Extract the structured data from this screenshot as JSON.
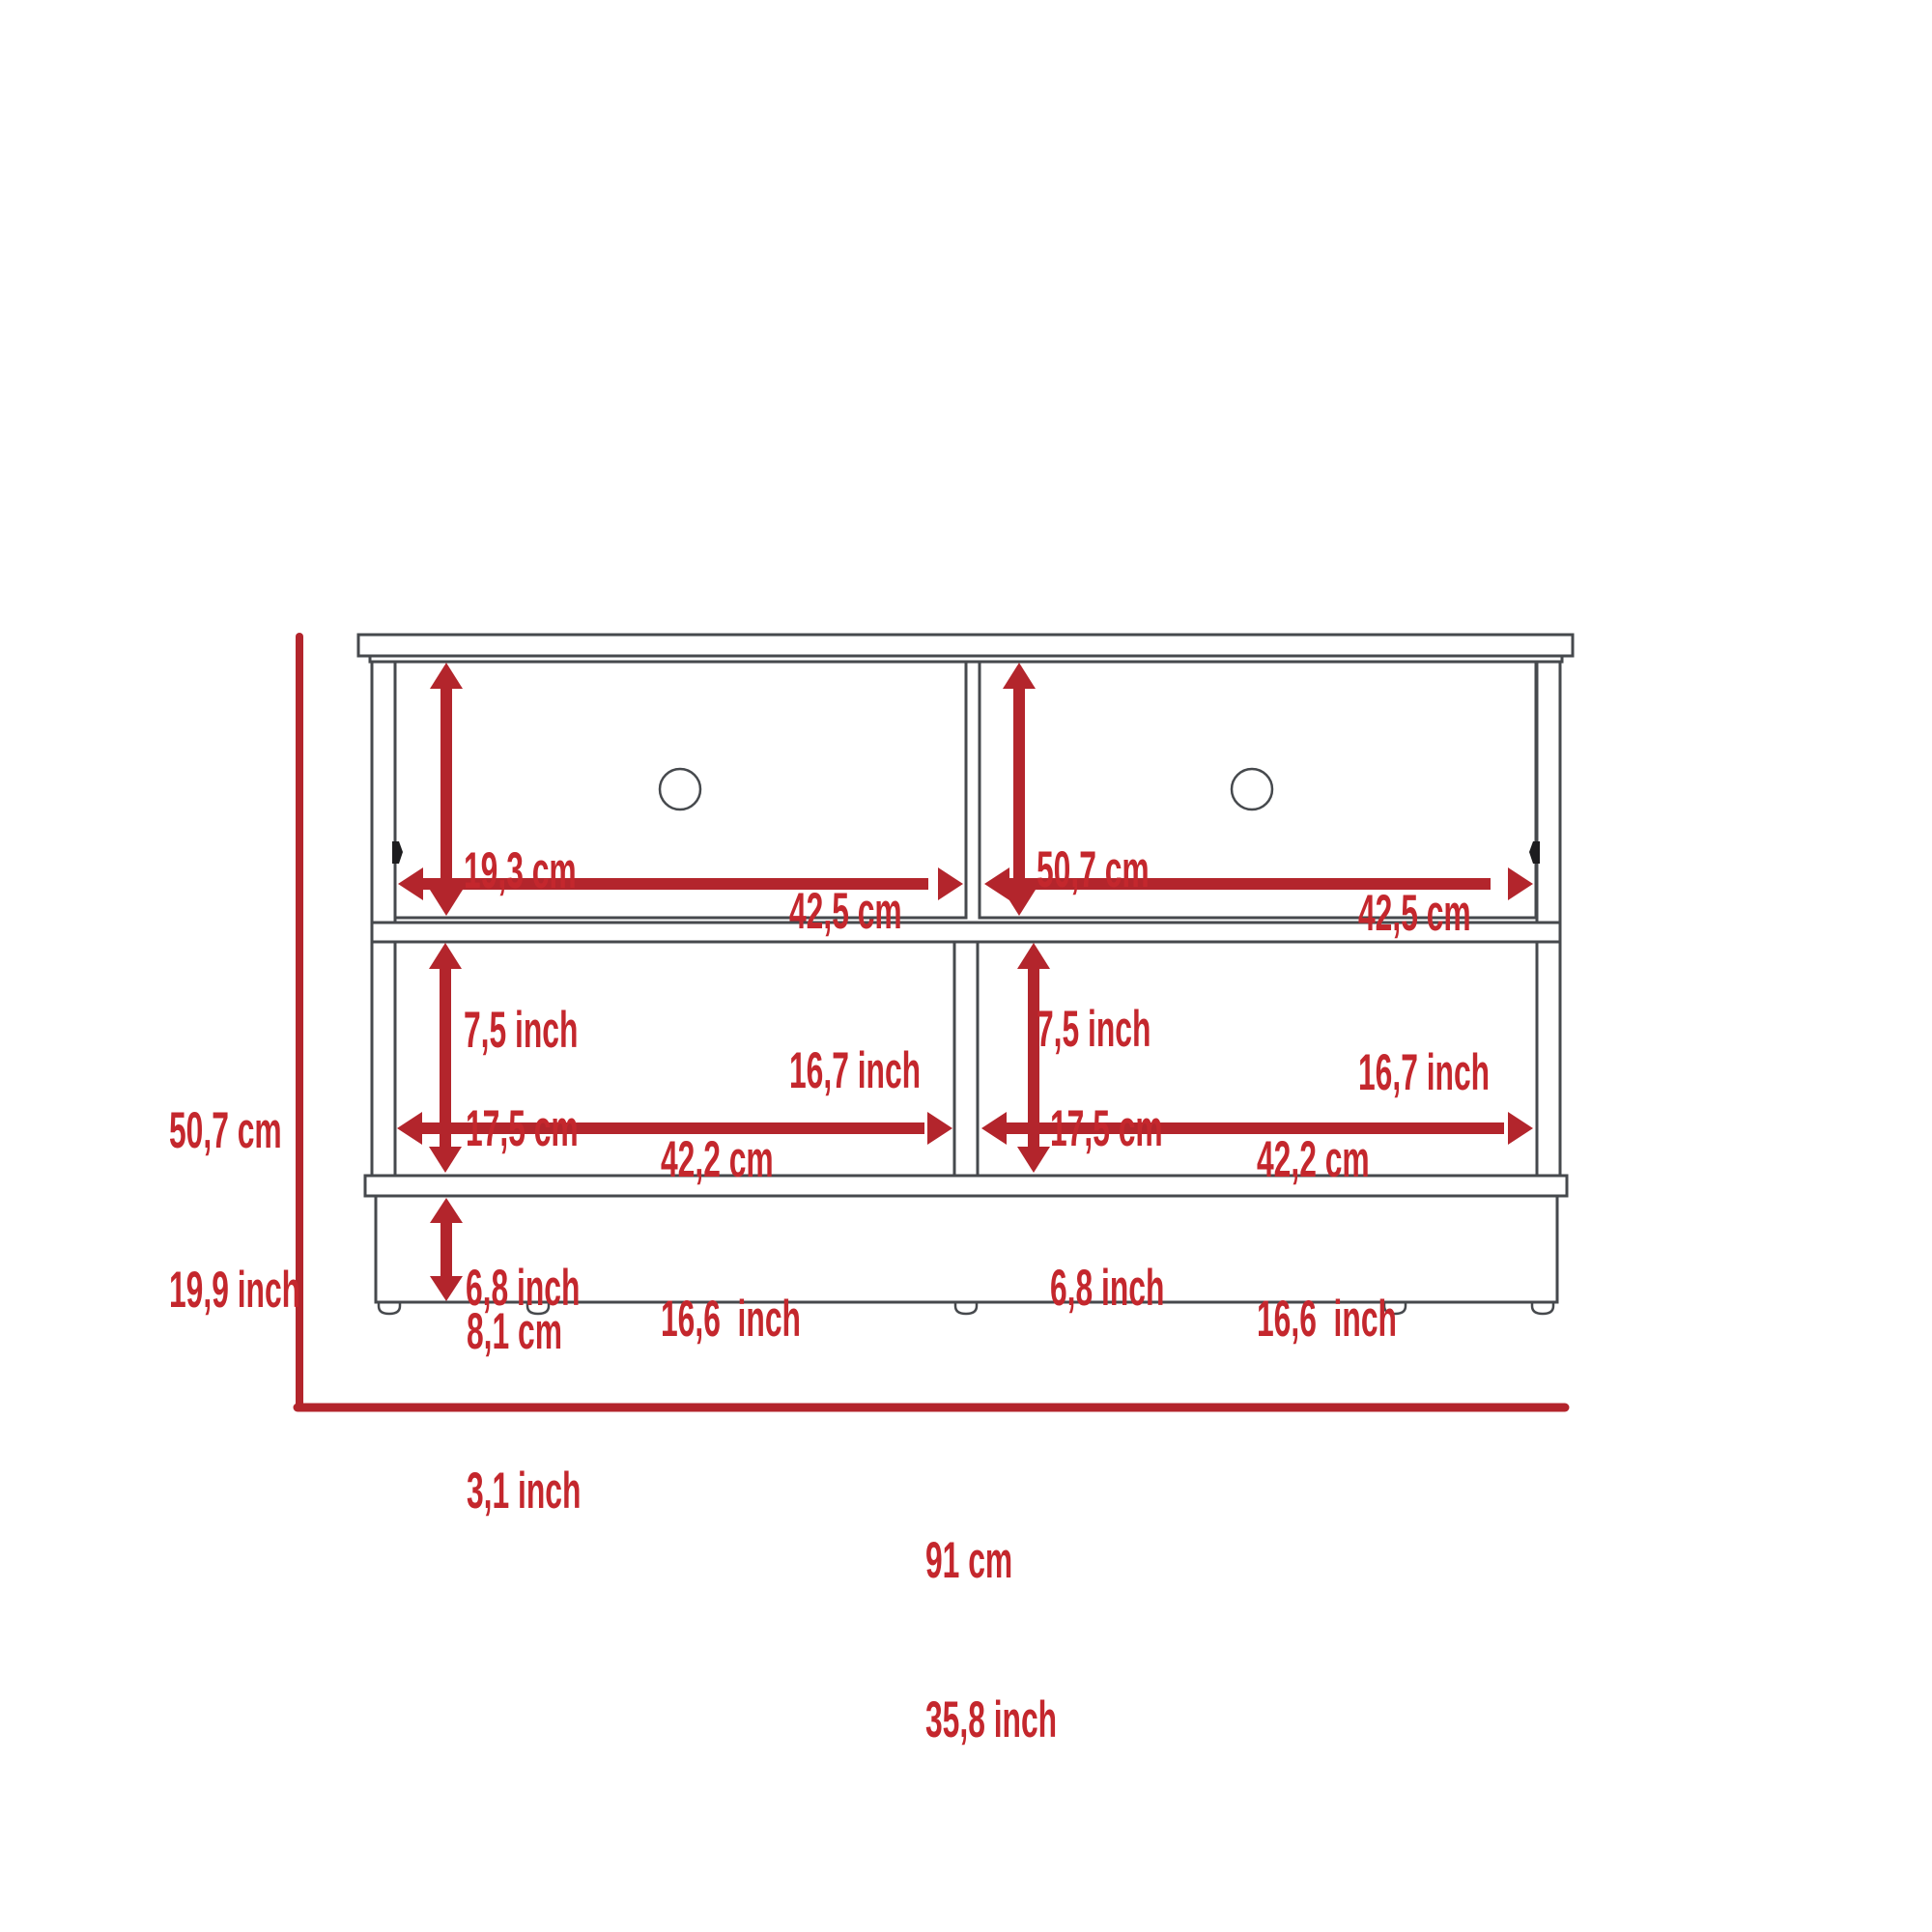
{
  "colors": {
    "accent": "#b3252c",
    "accent-text": "#c4272d",
    "line": "#46494d"
  },
  "dimensions": {
    "overall": {
      "height": {
        "cm": "50,7 cm",
        "inch": "19,9 inch"
      },
      "width": {
        "cm": "91 cm",
        "inch": "35,8 inch"
      }
    },
    "drawer_left": {
      "height": {
        "cm": "19,3 cm",
        "inch": "7,5 inch"
      },
      "width": {
        "cm": "42,5 cm",
        "inch": "16,7 inch"
      }
    },
    "drawer_right": {
      "height": {
        "cm": "50,7 cm",
        "inch": "7,5 inch"
      },
      "width": {
        "cm": "42,5 cm",
        "inch": "16,7 inch"
      }
    },
    "shelf_left": {
      "height": {
        "cm": "17,5 cm",
        "inch": "6,8 inch"
      },
      "width": {
        "cm": "42,2 cm",
        "inch": "16,6  inch"
      }
    },
    "shelf_right": {
      "height": {
        "cm": "17,5 cm",
        "inch": "6,8 inch"
      },
      "width": {
        "cm": "42,2 cm",
        "inch": "16,6  inch"
      }
    },
    "base": {
      "height": {
        "cm": "8,1 cm",
        "inch": "3,1 inch"
      }
    }
  }
}
